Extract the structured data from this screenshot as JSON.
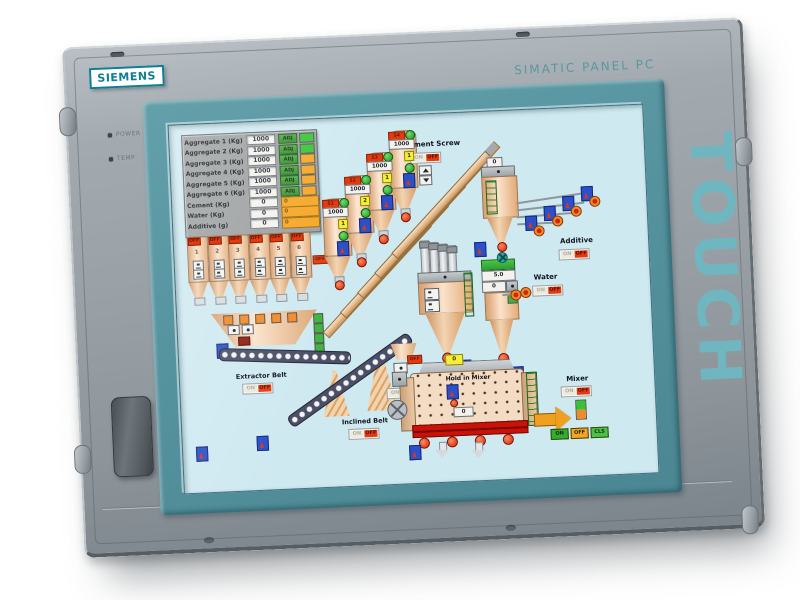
{
  "device": {
    "brand": "SIEMENS",
    "model": "SIMATIC PANEL PC",
    "touch": "TOUCH",
    "led_power": "POWER",
    "led_temp": "TEMP"
  },
  "colors": {
    "bezel_teal": "#55939f",
    "panel_gray": "#99a1a7",
    "touch_text": "#6fb6c0",
    "lcd_background": "#cfe9f1",
    "alarm_red": "#e23b10",
    "run_green": "#35c435",
    "warn_orange": "#f5a623"
  },
  "hmi": {
    "table": {
      "rows": [
        {
          "label": "Aggregate 1 (Kg)",
          "value": "1000",
          "button": "ADJ",
          "lamp": "green"
        },
        {
          "label": "Aggregate 2 (Kg)",
          "value": "1000",
          "button": "ADJ",
          "lamp": "green"
        },
        {
          "label": "Aggregate 3 (Kg)",
          "value": "1000",
          "button": "ADJ",
          "lamp": "orange"
        },
        {
          "label": "Aggregate 4 (Kg)",
          "value": "1000",
          "button": "ADJ",
          "lamp": "orange"
        },
        {
          "label": "Aggregate 5 (Kg)",
          "value": "1000",
          "button": "ADJ",
          "lamp": "orange"
        },
        {
          "label": "Aggregate 6 (Kg)",
          "value": "1000",
          "button": "ADJ",
          "lamp": "orange"
        },
        {
          "label": "Cement (Kg)",
          "value": "0",
          "actual": "0"
        },
        {
          "label": "Water (Kg)",
          "value": "0",
          "actual": "0"
        },
        {
          "label": "Additive (g)",
          "value": "0",
          "actual": "0"
        }
      ]
    },
    "bins": {
      "off": "OFF",
      "items": [
        {
          "num": "1"
        },
        {
          "num": "2"
        },
        {
          "num": "3"
        },
        {
          "num": "4"
        },
        {
          "num": "5"
        },
        {
          "num": "6"
        }
      ]
    },
    "extractor_belt": {
      "label": "Extractor Belt",
      "on": "ON",
      "off": "OFF"
    },
    "inclined_belt": {
      "label": "Inclined Belt",
      "on": "ON",
      "off": "OFF"
    },
    "transfer_gate": {
      "tag": "OFF",
      "on": "ON",
      "off": "OFF"
    },
    "cement_screw": {
      "label": "Cement Screw",
      "on": "ON",
      "off": "OFF"
    },
    "silos": [
      {
        "id": "S1",
        "value": "1000",
        "seq": "1"
      },
      {
        "id": "S2",
        "value": "1000",
        "seq": "2"
      },
      {
        "id": "S3",
        "value": "1000",
        "seq": "1"
      },
      {
        "id": "S4",
        "value": "1000",
        "seq": "1"
      }
    ],
    "water": {
      "label": "Water",
      "setpoint": "5.0",
      "value": "0",
      "on": "ON",
      "off": "OFF"
    },
    "additive": {
      "label": "Additive",
      "value": "0",
      "on": "ON",
      "off": "OFF"
    },
    "mixer": {
      "label": "Mixer",
      "hold_label": "Hold in Mixer",
      "hold_value": "0",
      "inlet_value": "0",
      "on": "ON",
      "off": "OFF",
      "btn_on": "ON",
      "btn_off": "OFF",
      "btn_cls": "CLS"
    }
  }
}
